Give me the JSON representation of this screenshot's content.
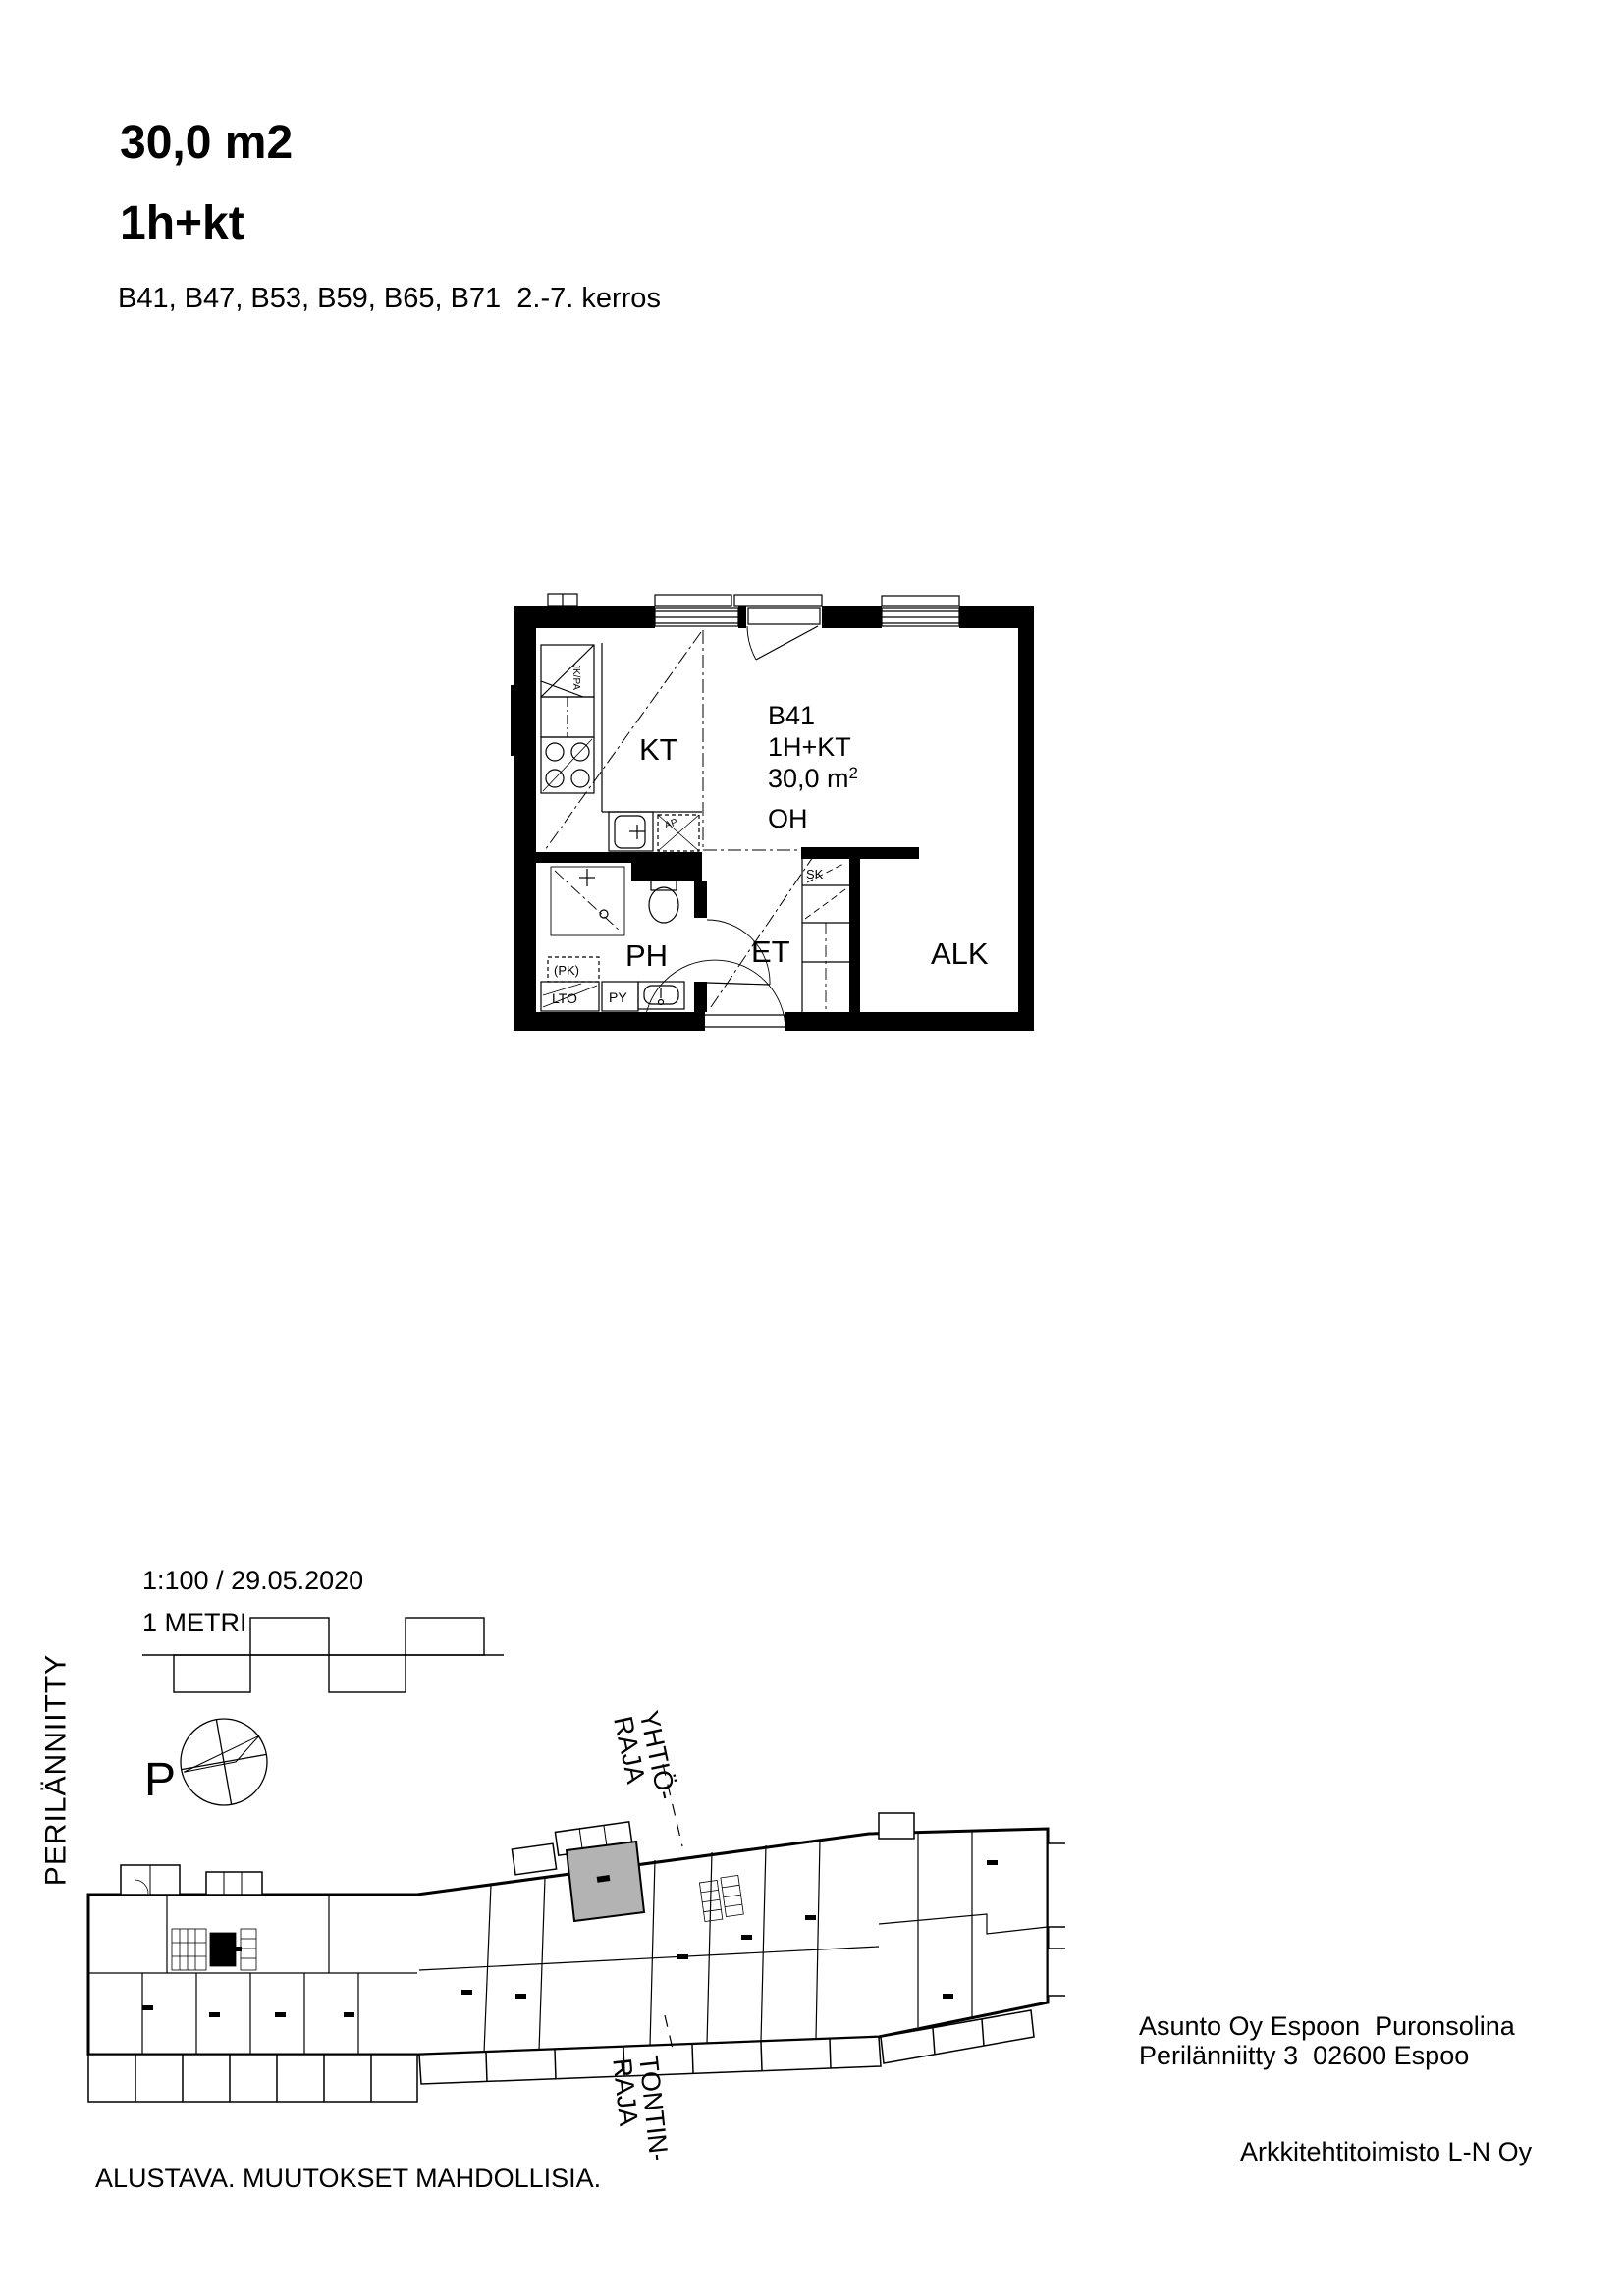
{
  "header": {
    "area": "30,0 m2",
    "type": "1h+kt",
    "apartments": "B41, B47, B53, B59, B65, B71  2.-7. kerros"
  },
  "floor_plan": {
    "unit_id": "B41",
    "unit_type": "1H+KT",
    "area_main": "30,0 m",
    "area_sup": "2",
    "living_room": "OH",
    "kitchen": "KT",
    "bathroom": "PH",
    "entry": "ET",
    "alcove": "ALK",
    "closet": "SK",
    "fridge": "JK/PA",
    "dishwasher": "AP",
    "laundry_reserve": "(PK)",
    "heat_recovery": "LTO",
    "dryer": "PY"
  },
  "scale_block": {
    "ratio_date": "1:100 / 29.05.2020",
    "unit_label": "1 METRI"
  },
  "compass": {
    "north_label": "P"
  },
  "site_plan": {
    "street": "PERILÄNNIITTY",
    "company_boundary_line1": "YHTIÖ-",
    "company_boundary_line2": "RAJA",
    "plot_boundary_line1": "TONTIN-",
    "plot_boundary_line2": "RAJA",
    "highlight_color": "#b3b3b3"
  },
  "footer": {
    "disclaimer": "ALUSTAVA. MUUTOKSET MAHDOLLISIA.",
    "company": "Asunto Oy Espoon  Puronsolina",
    "address": "Perilänniitty 3  02600 Espoo",
    "architect": "Arkkitehtitoimisto L-N Oy"
  }
}
